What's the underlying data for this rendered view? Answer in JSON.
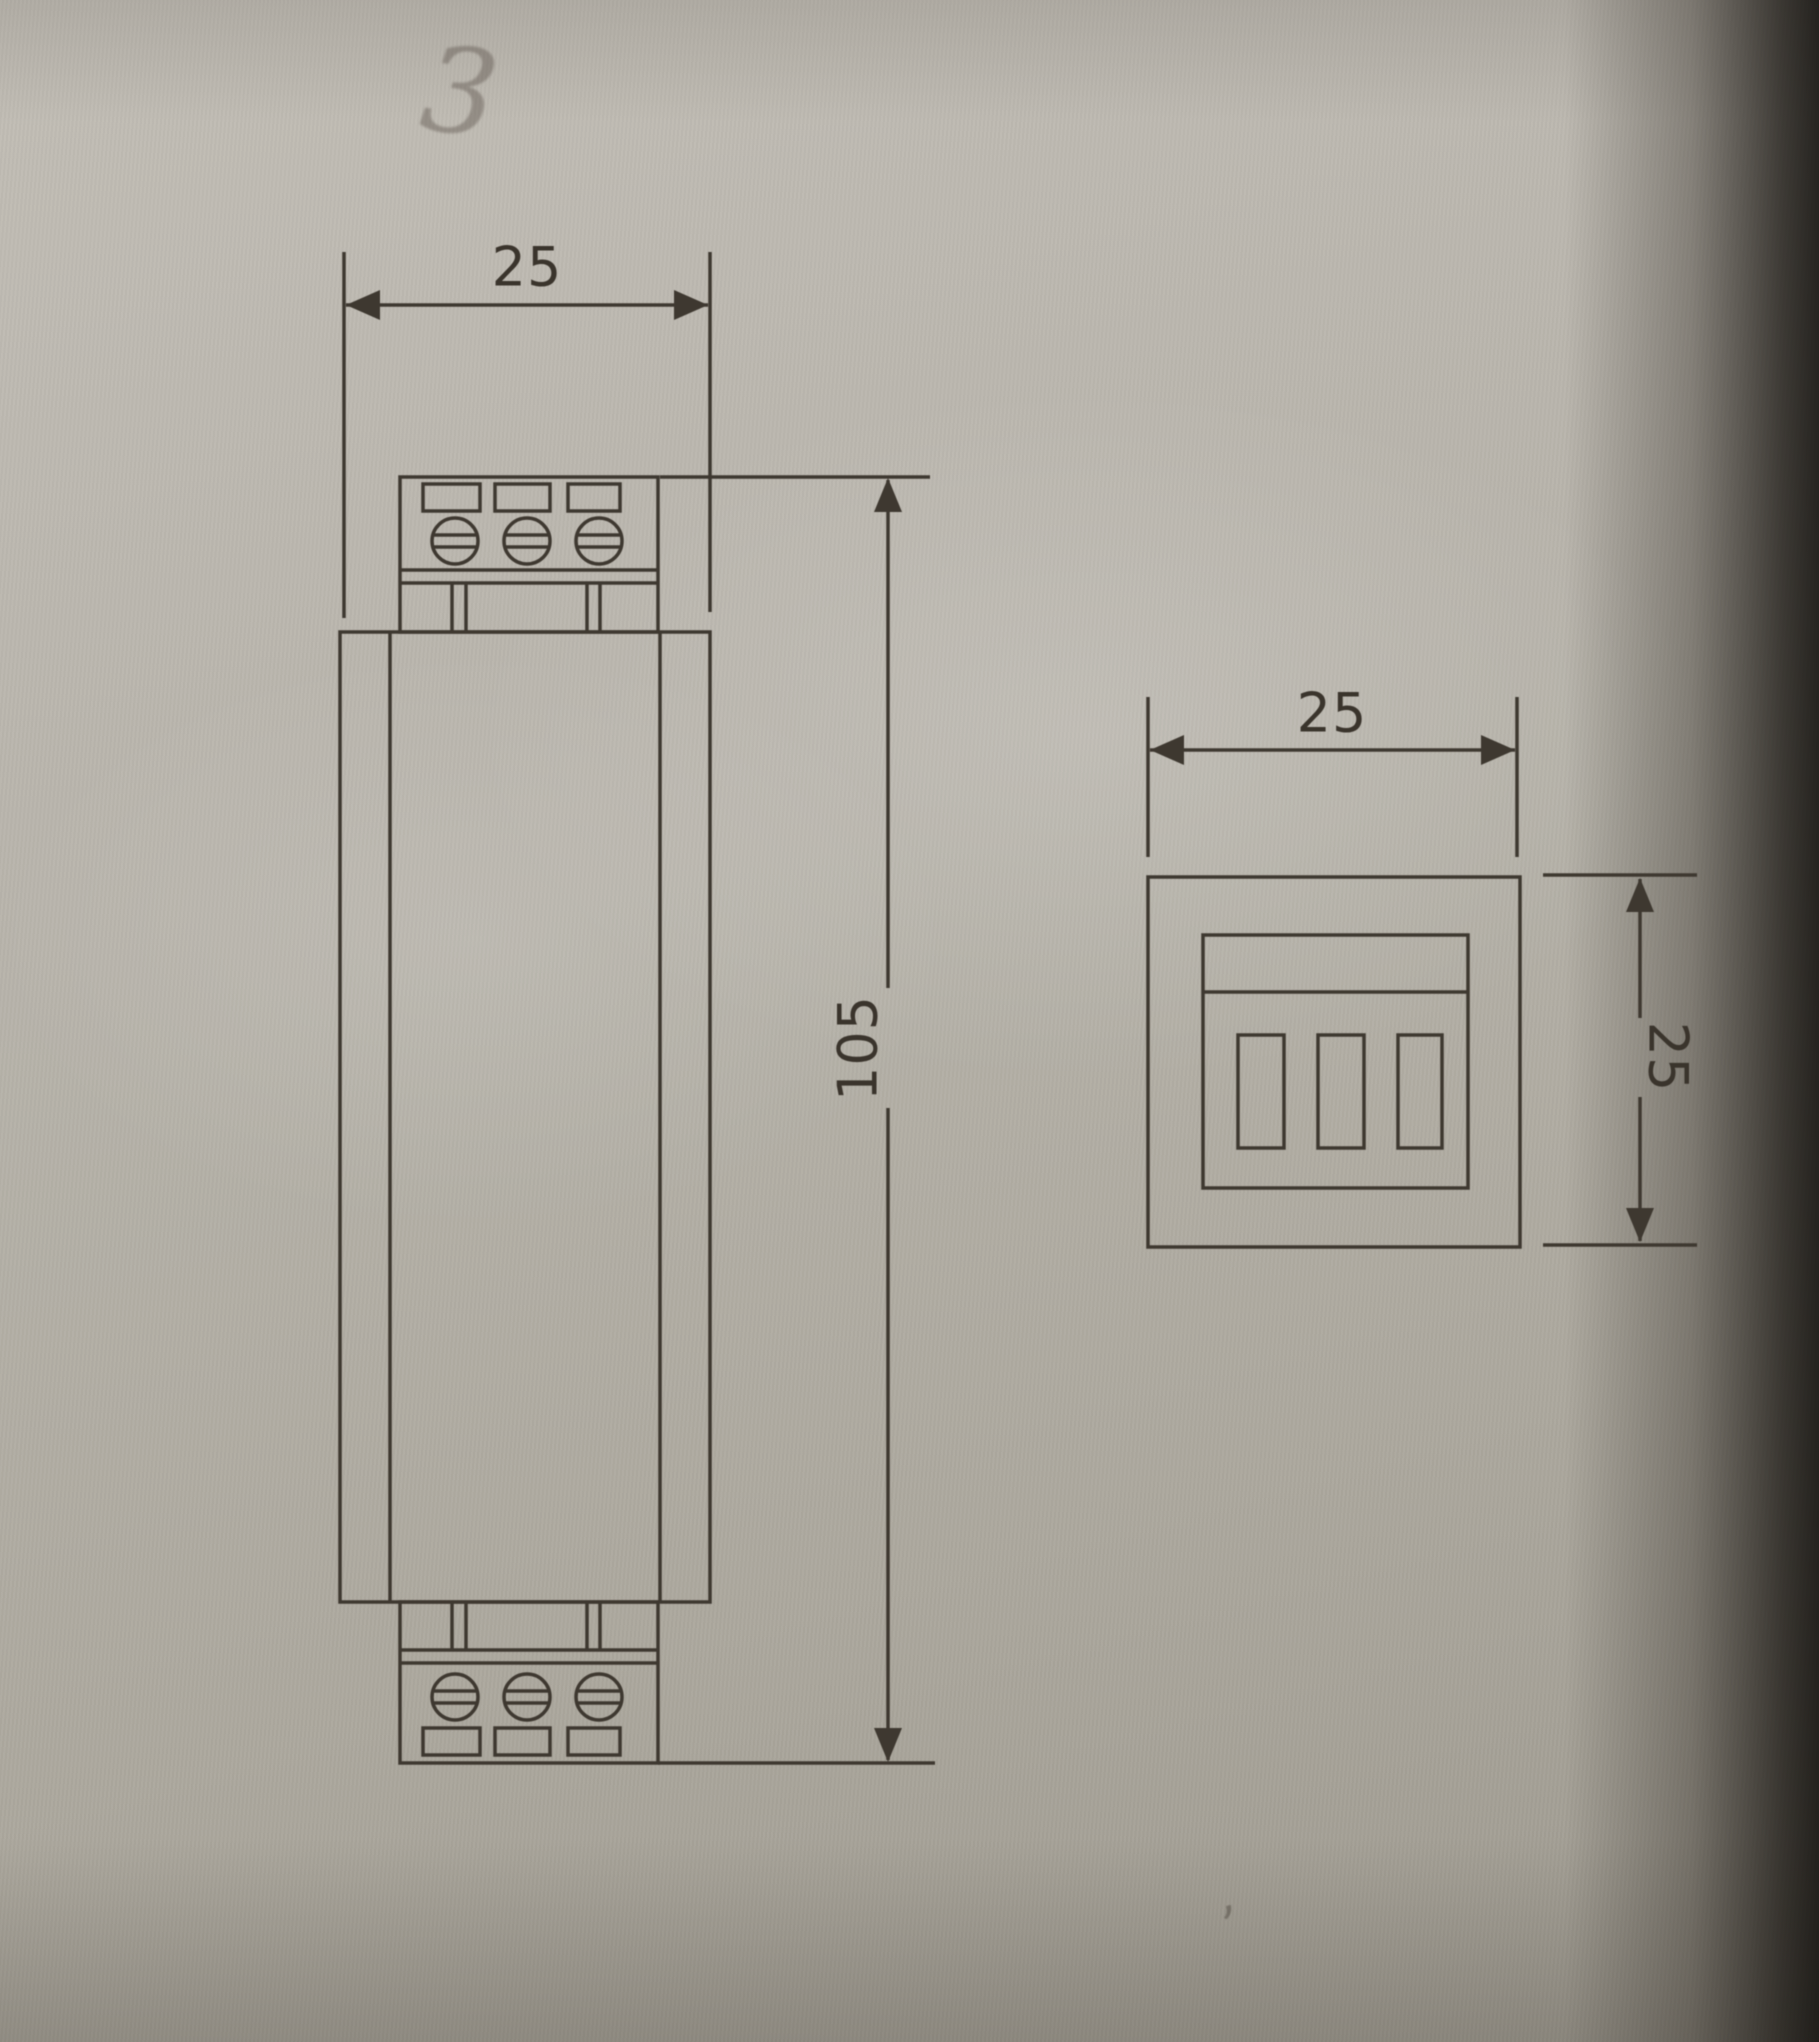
{
  "document": {
    "type": "technical-dimension-drawing",
    "views": [
      "front-view",
      "end-view"
    ]
  },
  "front_view": {
    "width_dim": {
      "label": "25"
    },
    "height_dim": {
      "label": "105"
    }
  },
  "end_view": {
    "width_dim": {
      "label": "25"
    },
    "height_dim": {
      "label": "25"
    }
  },
  "annotations": {
    "handwritten_note": "3",
    "stray_mark": ","
  },
  "colors": {
    "line": "#3e3830",
    "label": "#3a342c",
    "paper": "#b5b1a8"
  }
}
